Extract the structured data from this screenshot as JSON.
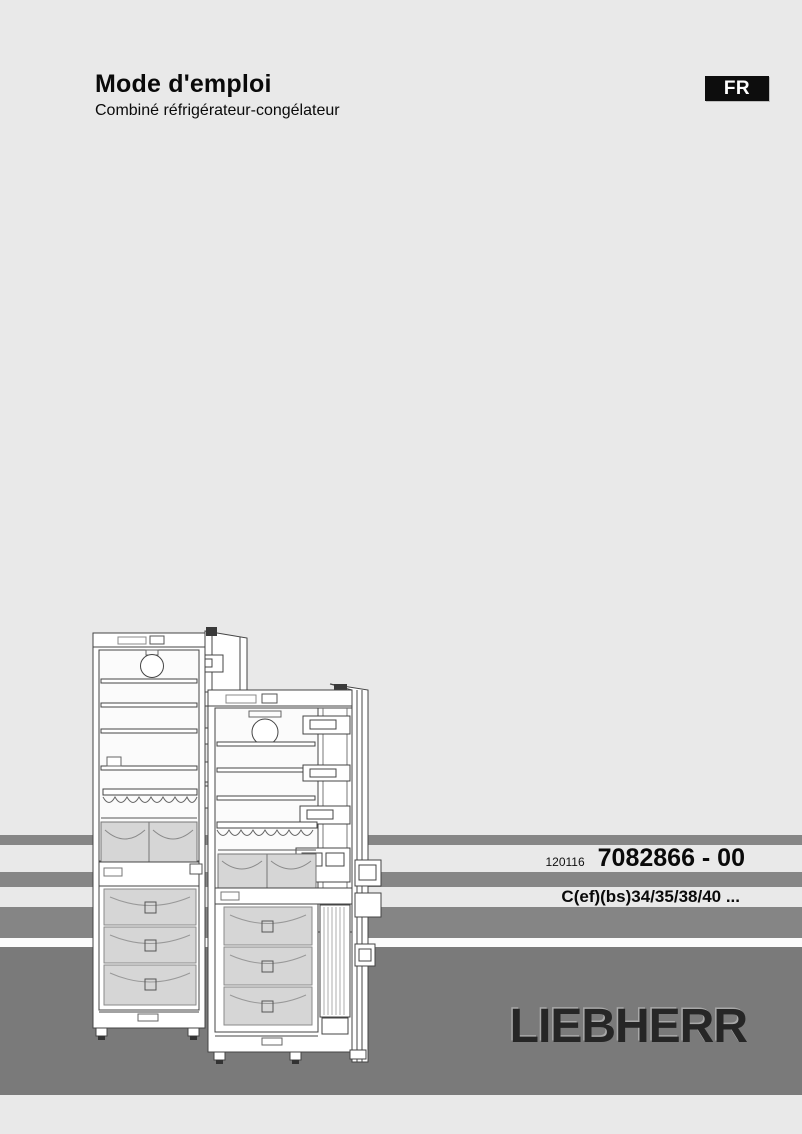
{
  "header": {
    "title": "Mode d'emploi",
    "subtitle": "Combiné réfrigérateur-congélateur",
    "language_badge": "FR"
  },
  "part_block": {
    "date_code": "120116",
    "document_number": "7082866 - 00",
    "model_line": "C(ef)(bs)34/35/38/40 ..."
  },
  "brand": {
    "logo": "LIEBHERR"
  },
  "illustration": {
    "name": "refrigerator-freezer-open-doors-line-art",
    "description": "Two combined refrigerator-freezers with open doors, interior shelves, crisper and freezer drawers"
  },
  "colors": {
    "page_bg": "#e9e9e9",
    "band_gray": "#868686",
    "band_dark": "#7a7a7a",
    "badge_bg": "#0d0d0d",
    "badge_text": "#ffffff",
    "logo_text": "#262626",
    "drawer_gray": "#d6d6d6"
  }
}
